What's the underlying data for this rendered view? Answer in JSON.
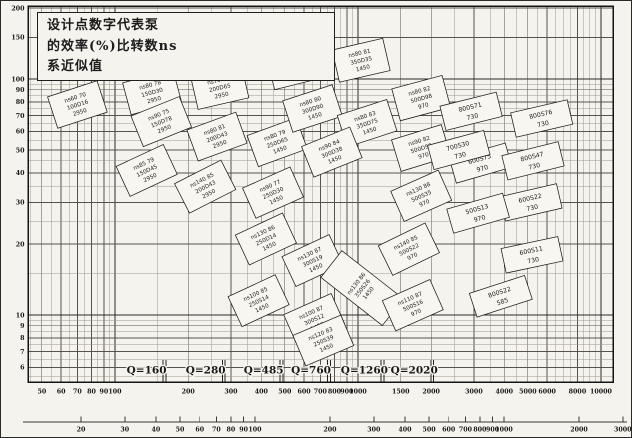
{
  "note": {
    "line1": "设计点数字代表泵",
    "line2": "的效率(%)比转数ns",
    "line3": "系近似值"
  },
  "chart_data": {
    "type": "scatter",
    "title": "",
    "grid": "log-log",
    "x_axis": {
      "scale": "log",
      "ticks": [
        50,
        60,
        70,
        80,
        90,
        100,
        200,
        300,
        400,
        500,
        600,
        700,
        800,
        900,
        1000,
        1500,
        2000,
        3000,
        4000,
        5000,
        6000,
        8000,
        10000
      ],
      "range": [
        44,
        11500
      ]
    },
    "y_axis": {
      "scale": "log",
      "ticks": [
        200,
        150,
        100,
        90,
        80,
        70,
        60,
        50,
        40,
        30,
        20,
        10,
        9,
        8,
        7,
        6
      ],
      "range": [
        5.3,
        205
      ]
    },
    "second_x_axis": {
      "scale": "log",
      "ticks": [
        20,
        30,
        40,
        50,
        60,
        70,
        80,
        90,
        100,
        200,
        300,
        400,
        500,
        600,
        700,
        800,
        900,
        1000,
        2000,
        3000
      ]
    },
    "q_boundaries": [
      {
        "label": "Q=160",
        "value": 160
      },
      {
        "label": "Q=280",
        "value": 280
      },
      {
        "label": "Q=485",
        "value": 485
      },
      {
        "label": "Q=760",
        "value": 760
      },
      {
        "label": "Q=1260",
        "value": 1260
      },
      {
        "label": "Q=2020",
        "value": 2020
      }
    ],
    "pump_labels": [
      {
        "q": 70,
        "h": 78,
        "rot": -18,
        "lines": [
          "ns60 70",
          "100D16",
          "2950"
        ]
      },
      {
        "q": 142,
        "h": 88,
        "rot": -15,
        "lines": [
          "ns80 78",
          "150D30",
          "2950"
        ]
      },
      {
        "q": 270,
        "h": 92,
        "rot": -13,
        "lines": [
          "ns70 77",
          "200D65",
          "2950"
        ]
      },
      {
        "q": 155,
        "h": 66,
        "rot": -22,
        "lines": [
          "ns90 75",
          "150D78",
          "2950"
        ]
      },
      {
        "q": 263,
        "h": 57,
        "rot": -20,
        "lines": [
          "ns80 81",
          "200D43",
          "2950"
        ]
      },
      {
        "q": 465,
        "h": 54,
        "rot": -20,
        "lines": [
          "ns80 79",
          "250D65",
          "1450"
        ]
      },
      {
        "q": 135,
        "h": 41,
        "rot": -25,
        "lines": [
          "ns85 79",
          "150D45",
          "2950"
        ]
      },
      {
        "q": 235,
        "h": 35,
        "rot": -27,
        "lines": [
          "ns140 85",
          "200D43",
          "2950"
        ]
      },
      {
        "q": 447,
        "h": 33,
        "rot": -24,
        "lines": [
          "ns90 77",
          "250D30",
          "1450"
        ]
      },
      {
        "q": 418,
        "h": 21,
        "rot": -25,
        "lines": [
          "ns130 86",
          "250D14",
          "1450"
        ]
      },
      {
        "q": 555,
        "h": 112,
        "rot": -14,
        "lines": [
          "ns75 78",
          "250D26",
          "1450"
        ]
      },
      {
        "q": 650,
        "h": 75,
        "rot": -18,
        "lines": [
          "ns80 80",
          "300D90",
          "1450"
        ]
      },
      {
        "q": 1030,
        "h": 120,
        "rot": -13,
        "lines": [
          "ns80 81",
          "350D35",
          "1450"
        ]
      },
      {
        "q": 1090,
        "h": 65,
        "rot": -18,
        "lines": [
          "ns80 83",
          "350D75",
          "1450"
        ]
      },
      {
        "q": 780,
        "h": 49,
        "rot": -22,
        "lines": [
          "ns90 84",
          "300D38",
          "1450"
        ]
      },
      {
        "q": 1820,
        "h": 83,
        "rot": -15,
        "lines": [
          "ns80 82",
          "500D98",
          "970"
        ]
      },
      {
        "q": 1820,
        "h": 51,
        "rot": -17,
        "lines": [
          "ns90 82",
          "500D59",
          "970"
        ]
      },
      {
        "q": 2920,
        "h": 73,
        "rot": -14,
        "lines": [
          "800S71",
          "730"
        ]
      },
      {
        "q": 3200,
        "h": 44,
        "rot": -16,
        "lines": [
          "600S75",
          "970"
        ]
      },
      {
        "q": 2600,
        "h": 50,
        "rot": -15,
        "lines": [
          "700S30",
          "730"
        ]
      },
      {
        "q": 5700,
        "h": 68,
        "rot": -13,
        "lines": [
          "800S76",
          "730"
        ]
      },
      {
        "q": 5250,
        "h": 45,
        "rot": -14,
        "lines": [
          "800S47",
          "730"
        ]
      },
      {
        "q": 5150,
        "h": 30,
        "rot": -13,
        "lines": [
          "600S22",
          "730"
        ]
      },
      {
        "q": 3120,
        "h": 27,
        "rot": -16,
        "lines": [
          "500S13",
          "970"
        ]
      },
      {
        "q": 1820,
        "h": 32,
        "rot": -24,
        "lines": [
          "ns130 88",
          "500S35",
          "970"
        ]
      },
      {
        "q": 1620,
        "h": 19,
        "rot": -26,
        "lines": [
          "ns140 85",
          "500S22",
          "970"
        ]
      },
      {
        "q": 5200,
        "h": 18,
        "rot": -12,
        "lines": [
          "600S11",
          "730"
        ]
      },
      {
        "q": 3870,
        "h": 12,
        "rot": -18,
        "lines": [
          "800S22",
          "585"
        ]
      },
      {
        "q": 390,
        "h": 11.5,
        "rot": -25,
        "lines": [
          "ns100 85",
          "250S14",
          "1450"
        ]
      },
      {
        "q": 650,
        "h": 17,
        "rot": -25,
        "lines": [
          "ns130 87",
          "300S19",
          "1450"
        ]
      },
      {
        "q": 660,
        "h": 9.6,
        "rot": -24,
        "lines": [
          "ns100 87",
          "300S12",
          "1450"
        ]
      },
      {
        "q": 1040,
        "h": 13,
        "rot": -52,
        "tall": true,
        "lines": [
          "ns130 86",
          "350S26",
          "1450"
        ]
      },
      {
        "q": 1680,
        "h": 11,
        "rot": -24,
        "lines": [
          "ns110 87",
          "500S16",
          "970"
        ]
      },
      {
        "q": 720,
        "h": 7.8,
        "rot": -23,
        "lines": [
          "ns120 83",
          "250S39",
          "1450"
        ]
      }
    ]
  }
}
